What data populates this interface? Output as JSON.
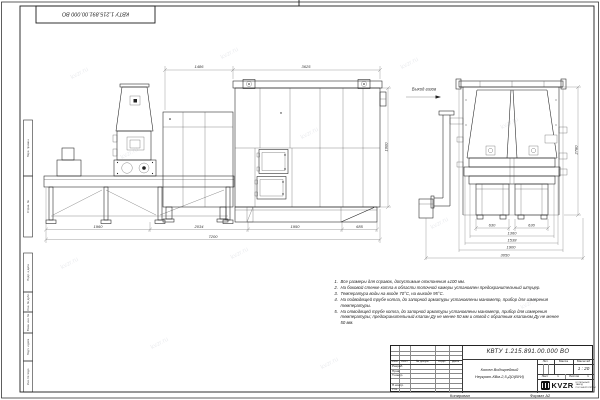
{
  "watermark": "kvzr.ru",
  "frame": {
    "stamp_top": "КВТУ 1.215.891.00.000 ВО",
    "margin_labels": [
      "Перв. примен.",
      "Справ. №",
      "Подп. и дата",
      "Инв. № дубл.",
      "Взам. инв. №",
      "Подп. и дата",
      "Инв. № подл."
    ],
    "copied_label": "Копировал",
    "format_label": "Формат А2"
  },
  "drawing": {
    "outlet_label": "Выход газов",
    "dims": {
      "lv_top1": "1486",
      "lv_top2": "3625",
      "lv_b1": "1960",
      "lv_b2": "2034",
      "lv_b3": "1950",
      "lv_b4": "685",
      "lv_total": "7200",
      "lv_height": "1600",
      "rv_b1": "630",
      "rv_b2": "630",
      "rv_b3": "1360",
      "rv_b4": "1538",
      "rv_b5": "1900",
      "rv_total": "3050",
      "rv_height": "2780"
    }
  },
  "notes": {
    "items": [
      {
        "num": "1.",
        "text": "Все размеры для справок, допустимые отклонения ±100 мм."
      },
      {
        "num": "2.",
        "text": "На боковой стенке котла в области топочной камеры установлен предохранительный штуцер."
      },
      {
        "num": "3.",
        "text": "Температура воды на входе 70°С, на выходе 95°С."
      },
      {
        "num": "4.",
        "text": "На подводящей трубе котла, до запорной арматуры установлены манометр, прибор для измерения температуры."
      },
      {
        "num": "5.",
        "text": "На отводящей трубе котла, до запорной арматуры установлены манометр, прибор для измерения температуры; предохранительный клапан Ду не менее 50 мм и отвод с обратным клапаном Ду не менее 50 мм."
      }
    ]
  },
  "title_block": {
    "doc_number": "КВТУ 1.215.891.00.000 ВО",
    "product_line1": "Котел Водогрейный",
    "product_line2": "Неукрат-КВм-2,5-ДО(ВУИ)",
    "col_izm": "Изм.",
    "col_list": "Лист",
    "col_doc": "№ докум.",
    "col_sign": "Подп.",
    "col_date": "Дата",
    "row_razrab": "Разраб.",
    "row_prov": "Пров.",
    "row_tkontr": "Т.контр.",
    "row_nkontr": "Н.контр.",
    "row_utv": "Утв.",
    "lit_label": "Лит.",
    "mass_label": "Масса",
    "scale_label": "Масштаб",
    "scale_value": "1 : 20",
    "sheet_label": "Лист",
    "sheet_num": "1",
    "sheets_label": "Листов",
    "sheets_num": "1",
    "logo_text": "KVZR",
    "logo_sub1": "КОТЕЛЬНЫЙ ЗАВОД",
    "logo_sub2": "РОСЭНЕРГОПРОМ"
  }
}
